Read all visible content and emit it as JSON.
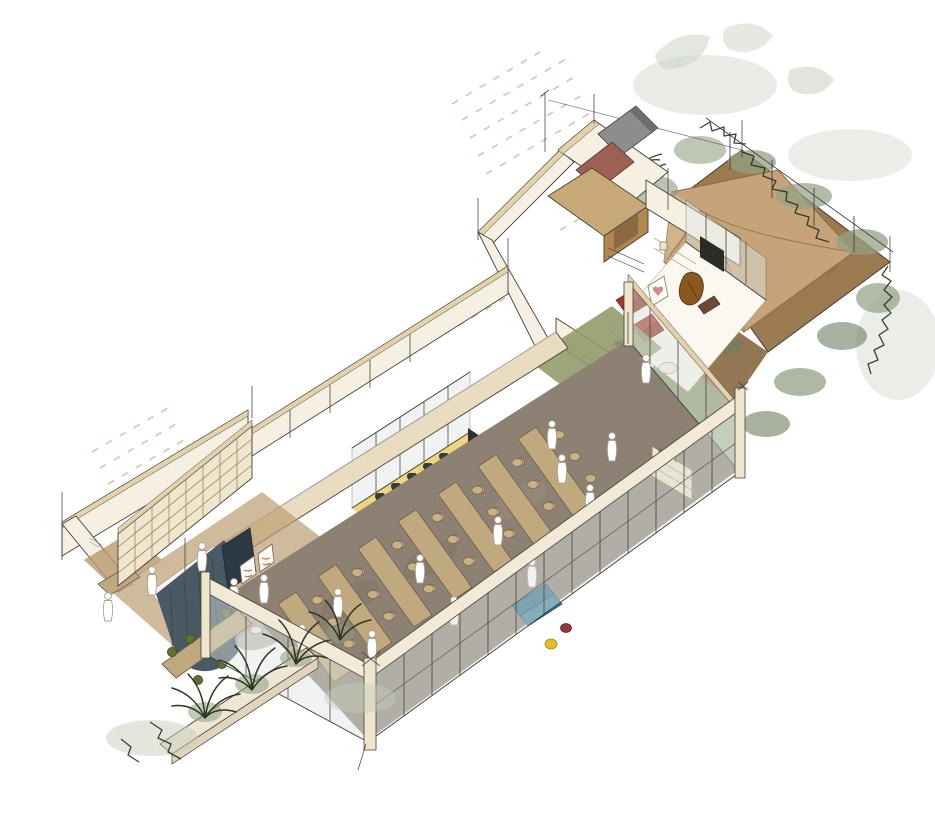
{
  "meta": {
    "description": "Hand-drawn watercolor axonometric cutaway sketch of a building floor: garden terrace with canvas canopy, tv lounge, utility rooms, meeting room, lunch niches, long glazed dining hall and a reading lounge wing with planted facade",
    "visible_text": []
  },
  "palette": {
    "paper": "#ffffff",
    "outline": "#44403a",
    "wallCream": "#f6f0e2",
    "wallCap": "#e3d1ab",
    "woodTan": "#c9a878",
    "woodTanDark": "#b0874f",
    "grayPanel": "#8d8d8d",
    "terracotta": "#9d6052",
    "gardenDirt": "#9b7a50",
    "gardenDirtDark": "#86683f",
    "gardenGrass": "#7e8b58",
    "canopy": "#c6a379",
    "canopyLight": "#dcc29c",
    "foliageDark": "#262d1c",
    "foliageSage": "#93a083",
    "foliageWash": "#ccd4c5",
    "crateGreen": "#2f5c33",
    "accentRed": "#a3362a",
    "accentRedDark": "#8c2c21",
    "heartPink": "#cf8d88",
    "chairBrown": "#8a581e",
    "floorGreen": "#8e9a68",
    "poufRed": "#b43c27",
    "floorYellow": "#e8cc5e",
    "nicheYellow": "#f0d264",
    "tableTan": "#c0a87f",
    "chairTan": "#c9b087",
    "chairBlack": "#383d40",
    "diningFloor": "#8c8173",
    "sofaBlue": "#3c7e9e",
    "boothBlue": "#2e6f8e",
    "chairYellow": "#e4bc25",
    "chairGreen": "#5f7030",
    "curtainSlate": "#4a5a64",
    "cabinetNavy": "#2b3a45",
    "rugGray": "#b5b2ab",
    "artOrange": "#c06a38",
    "shelfCream": "#f0e6ce",
    "glass": "#dfe6e3",
    "mullion": "#4a463e",
    "beamTan": "#e9dcc1",
    "hatch": "#cdbd9d",
    "personFill": "#ffffff",
    "personLine": "#aca28f"
  },
  "scene": {
    "style": "axonometric cutaway, ink outline with watercolor washes",
    "areas": [
      {
        "id": "garden-terrace",
        "label": "garden terrace with canopy"
      },
      {
        "id": "utility-rooms",
        "label": "utility rooms"
      },
      {
        "id": "tv-lounge",
        "label": "tv lounge"
      },
      {
        "id": "green-hallway",
        "label": "hallway"
      },
      {
        "id": "meeting-room",
        "label": "meeting room"
      },
      {
        "id": "office-nook",
        "label": "office nook"
      },
      {
        "id": "lunch-niches",
        "label": "lunch niches and booths"
      },
      {
        "id": "dining-hall",
        "label": "glazed dining hall"
      },
      {
        "id": "reading-lounge",
        "label": "reading lounge wing"
      },
      {
        "id": "planted-facade",
        "label": "planted facade"
      }
    ],
    "dining": {
      "table_count": 7,
      "origin": {
        "x": 278,
        "y": 604
      },
      "step": {
        "x": 40,
        "y": -27.5
      },
      "width": {
        "x": 18,
        "y": -12
      },
      "dir": {
        "x": 0.56,
        "y": 0.78
      },
      "length": 100,
      "chair_ts": [
        20,
        48,
        76
      ],
      "chair_sides": [
        {
          "dx": -12,
          "dy": 8
        },
        {
          "dx": 30,
          "dy": -20
        }
      ]
    },
    "people": [
      [
        338,
        606
      ],
      [
        372,
        648
      ],
      [
        302,
        642
      ],
      [
        420,
        572
      ],
      [
        454,
        614
      ],
      [
        498,
        534
      ],
      [
        532,
        576
      ],
      [
        562,
        472
      ],
      [
        590,
        502
      ],
      [
        612,
        450
      ],
      [
        646,
        372
      ],
      [
        552,
        438
      ],
      [
        108,
        610
      ],
      [
        152,
        584
      ],
      [
        202,
        560
      ],
      [
        234,
        596
      ],
      [
        264,
        592
      ]
    ]
  }
}
